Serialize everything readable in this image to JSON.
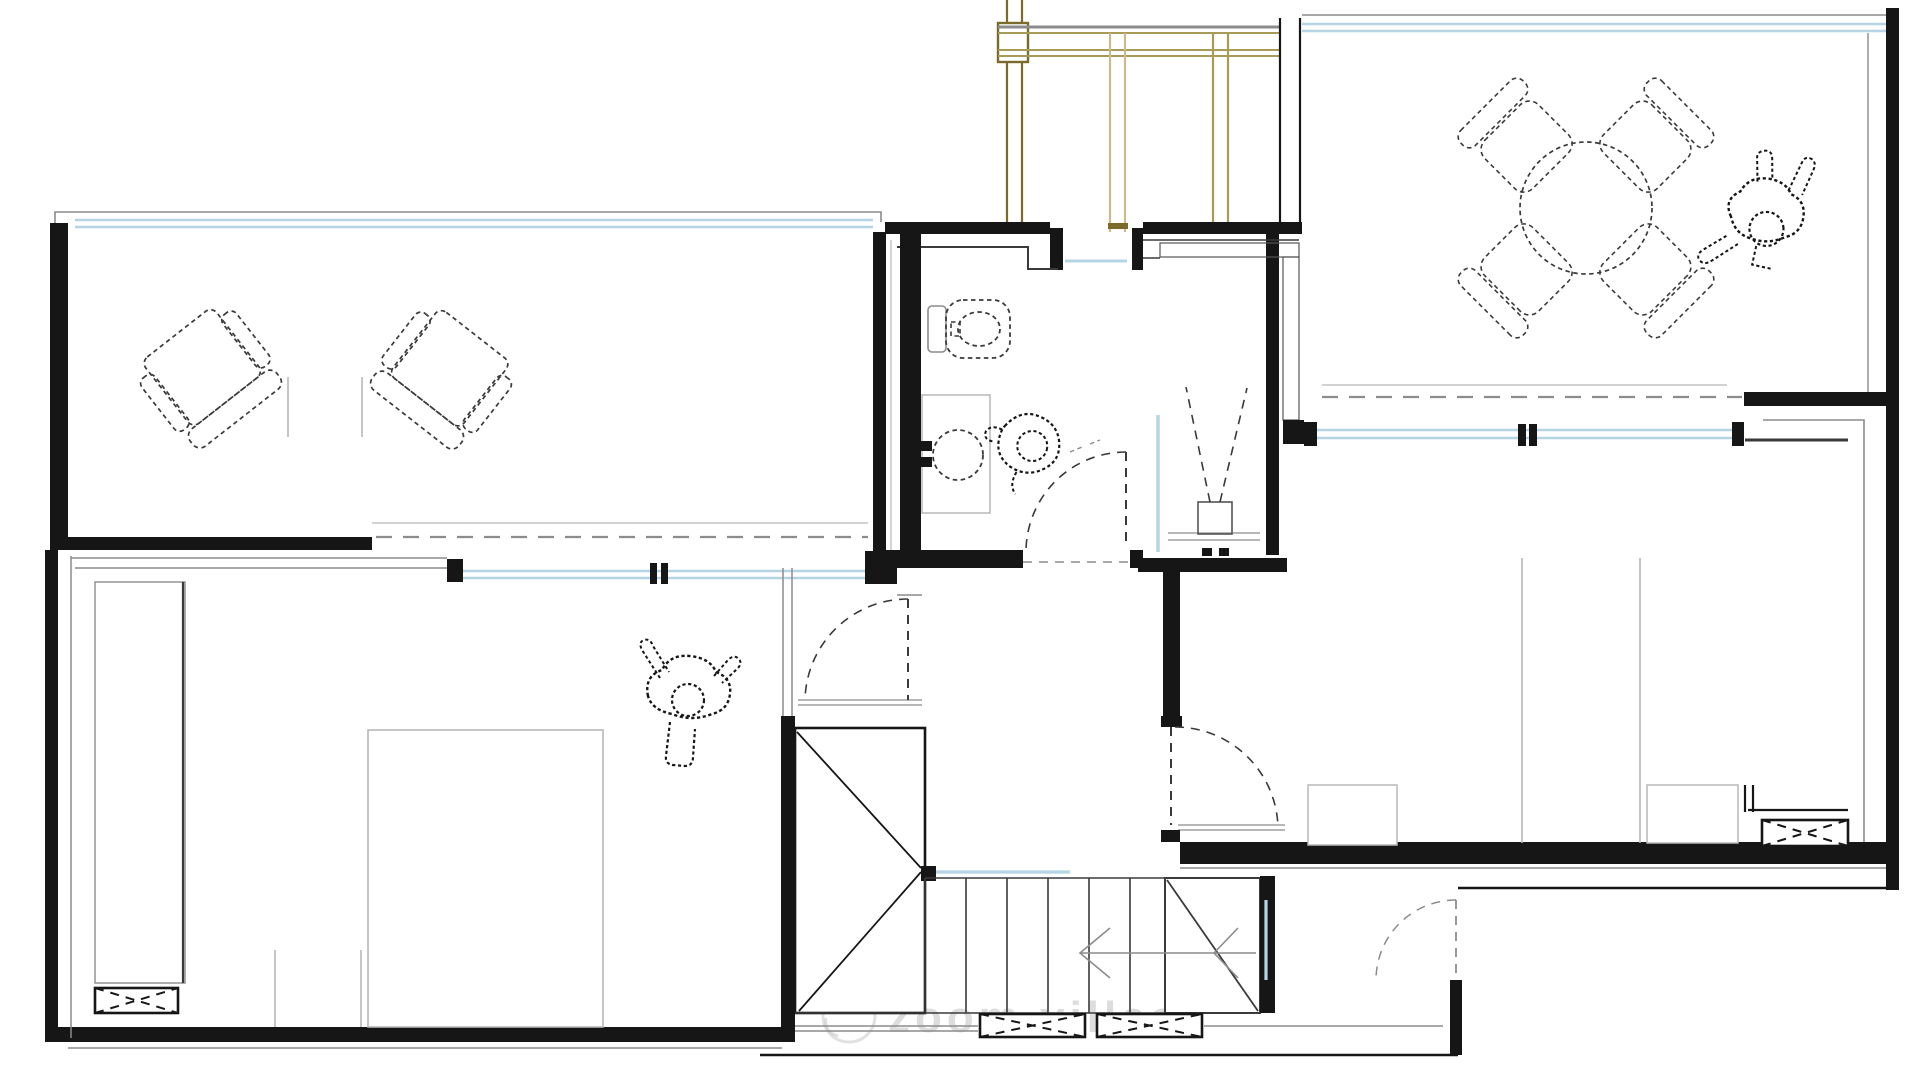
{
  "title": "architectural-floor-plan-upper-level",
  "watermark": {
    "logo": "camera-circle-logo",
    "text": "zoom villas"
  },
  "colors": {
    "wall": "#161616",
    "dark": "#3a3a3a",
    "gray": "#8c8c8c",
    "light": "#b8b8b8",
    "glass": "#b5d4e4",
    "beam-dark": "#7a6b2a",
    "beam-mid": "#a89b58",
    "beam-light": "#c7bb90",
    "hatch": "#8a8a8a",
    "watermark": "#c3c3c3"
  },
  "symbols": [
    "pergola-beams",
    "glazing-line",
    "void-dashed-line",
    "armchair",
    "side-table",
    "wardrobe-hatch",
    "dresser-x-box",
    "double-bed",
    "toilet",
    "washbasin",
    "potted-plant",
    "dining-table-round",
    "dining-chair",
    "person-figure",
    "stair-treads",
    "stair-flight-cross",
    "direction-arrow",
    "door-swing",
    "vent-box",
    "watermark-logo"
  ]
}
